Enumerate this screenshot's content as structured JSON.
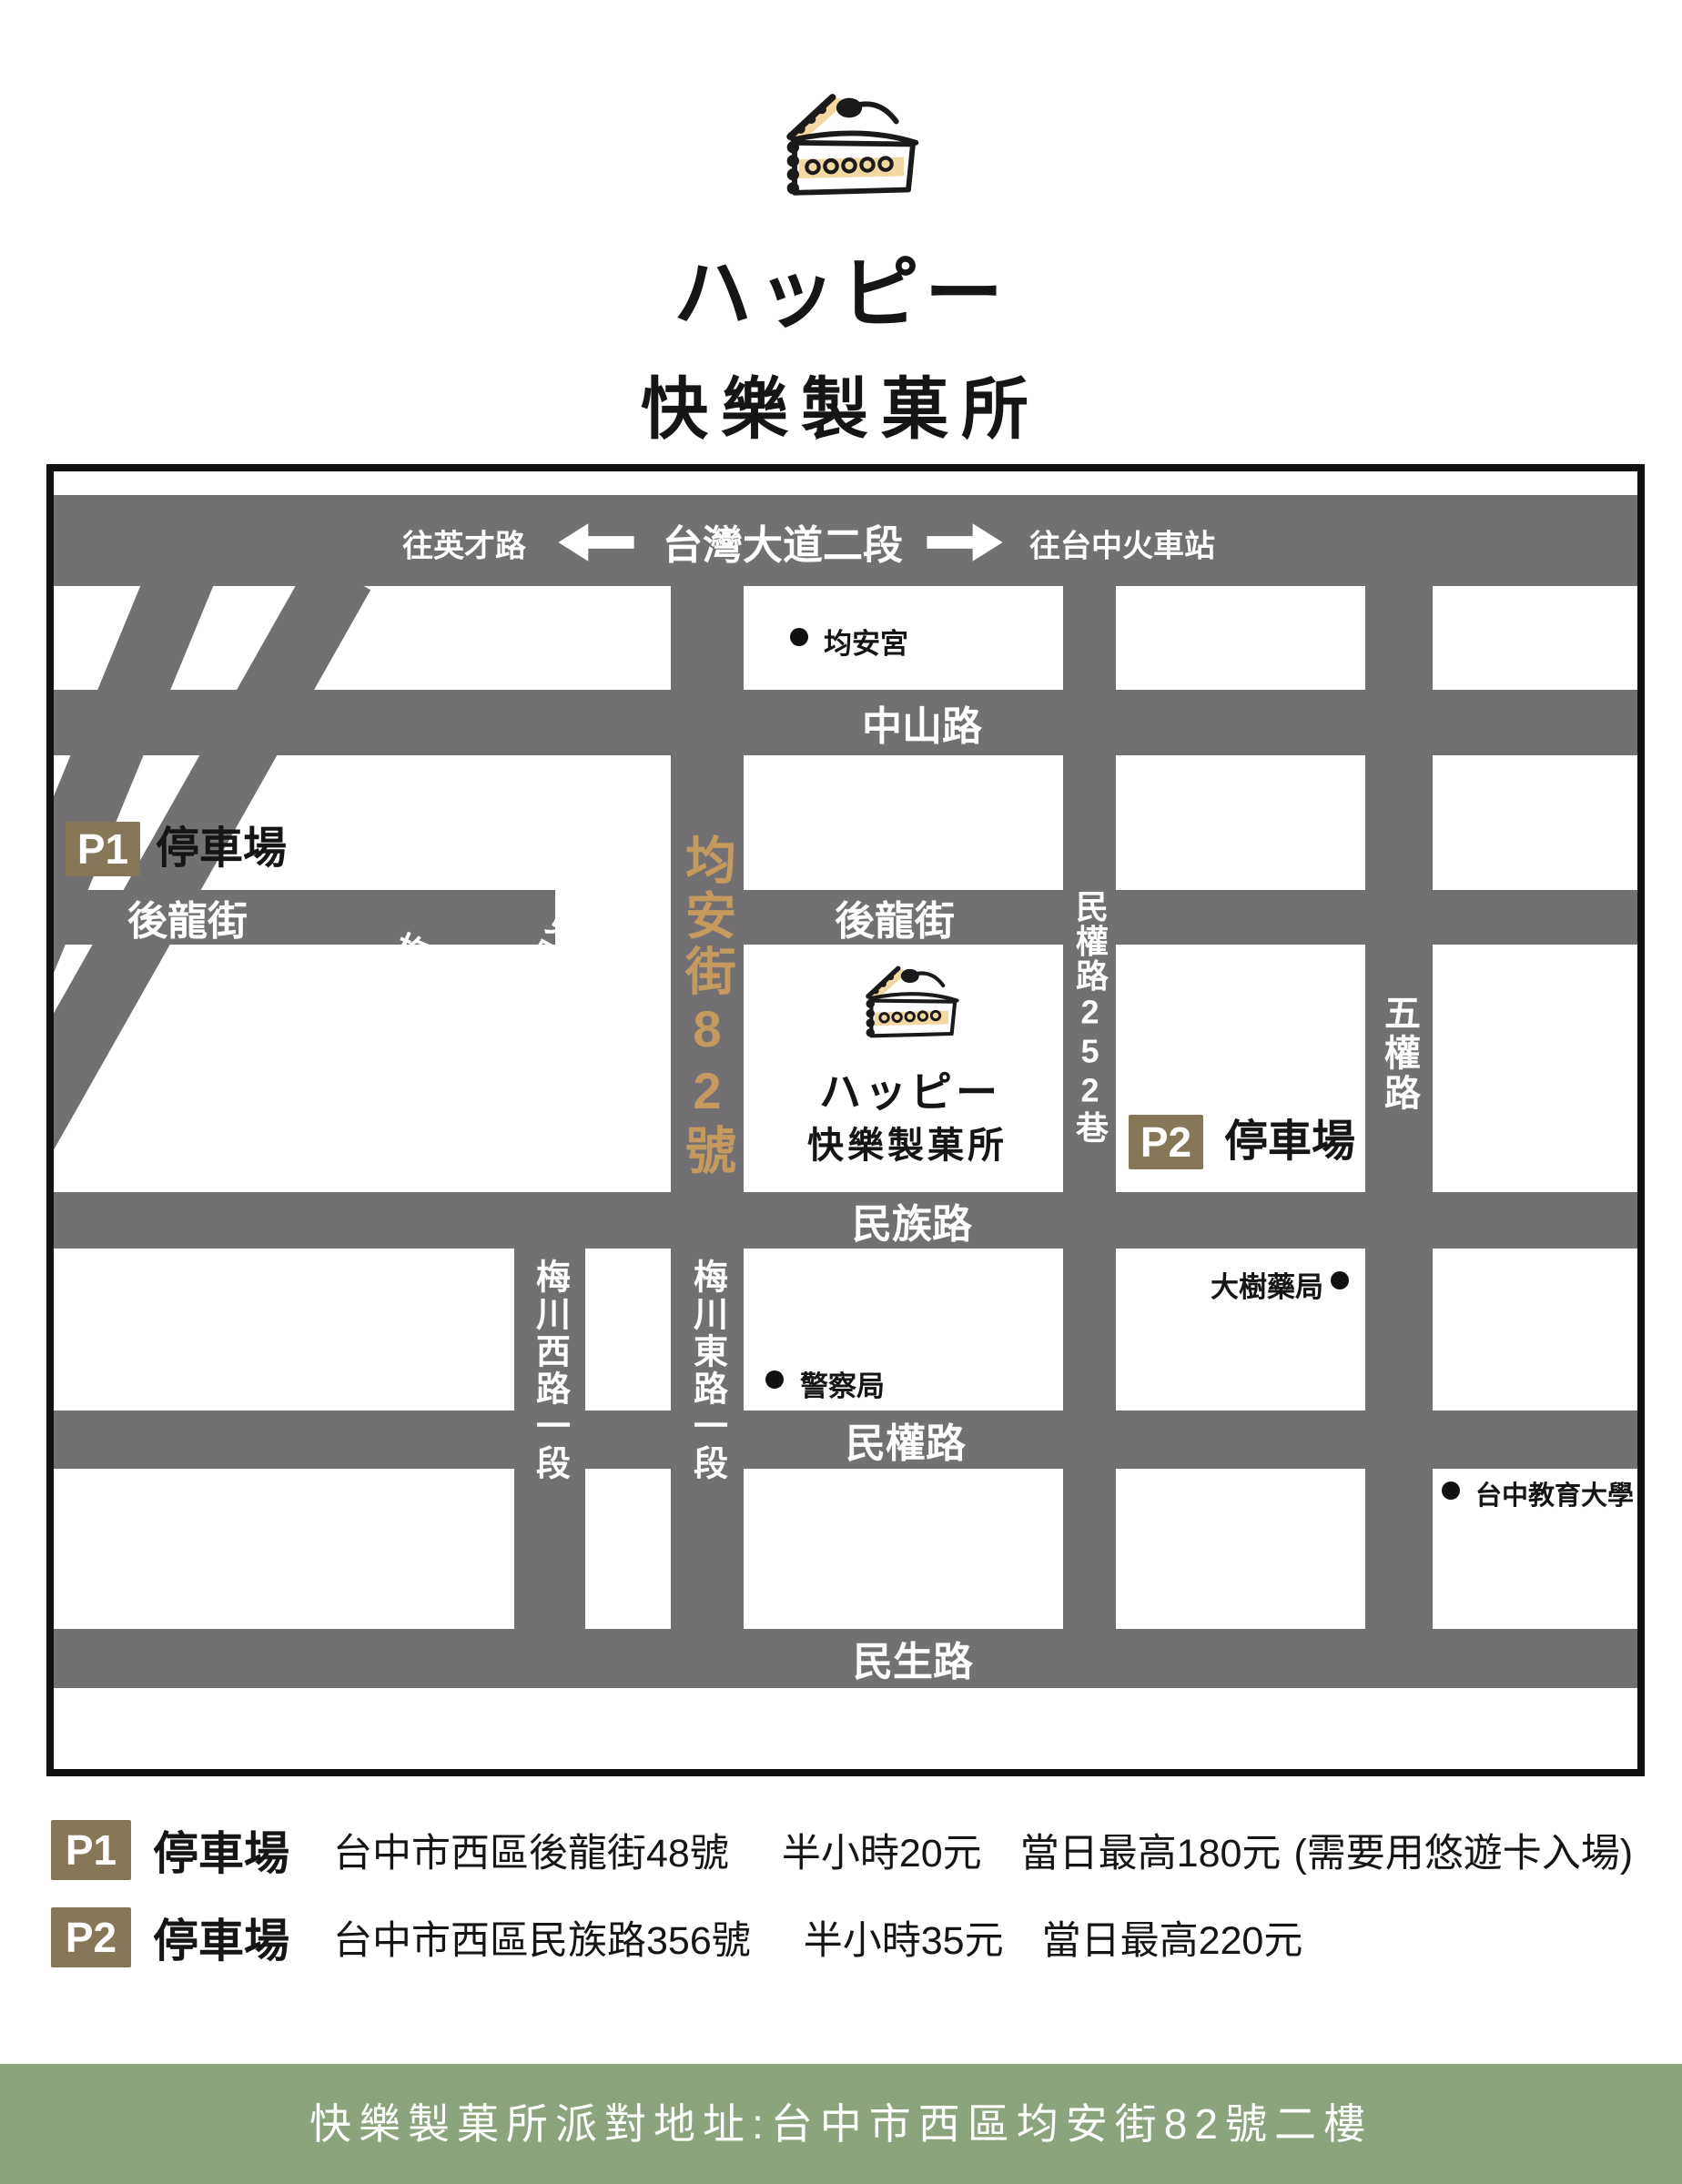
{
  "colors": {
    "road_gray": "#727072",
    "accent_gold": "#c49a5e",
    "badge_tan": "#877759",
    "footer_green": "#8ca47e",
    "cream": "#f2d8a2"
  },
  "header": {
    "brand_jp": "ハッピー",
    "brand_zh": "快樂製菓所"
  },
  "map": {
    "taiwan_blvd": {
      "label": "台灣大道二段",
      "to_left": "往英才路",
      "to_right": "往台中火車站"
    },
    "zhongshan": "中山路",
    "houlong_left": "後龍街",
    "houlong_right": "後龍街",
    "minzu": "民族路",
    "minquan": "民權路",
    "minsheng": "民生路",
    "junan": "均安街82號",
    "meichuan_w_diag": "梅川西路一段",
    "meichuan_e_diag": "梅川東路一段",
    "meichuan_w_v": "梅川西路一段",
    "meichuan_e_v": "梅川東路一段",
    "minquan252": "民權路252巷",
    "wuquan": "五權路",
    "poi_junangong": "均安宮",
    "poi_police": "警察局",
    "poi_pharmacy": "大樹藥局",
    "poi_university": "台中教育大學",
    "p1_badge": "P1",
    "p1_label": "停車場",
    "p2_badge": "P2",
    "p2_label": "停車場",
    "shop_jp": "ハッピー",
    "shop_zh": "快樂製菓所"
  },
  "parking": [
    {
      "badge": "P1",
      "type": "停車場",
      "address": "台中市西區後龍街48號",
      "rate": "半小時20元",
      "daily_max": "當日最高180元",
      "note": "(需要用悠遊卡入場)"
    },
    {
      "badge": "P2",
      "type": "停車場",
      "address": "台中市西區民族路356號",
      "rate": "半小時35元",
      "daily_max": "當日最高220元",
      "note": ""
    }
  ],
  "footer": {
    "address_line": "快樂製菓所派對地址:台中市西區均安街82號二樓"
  }
}
